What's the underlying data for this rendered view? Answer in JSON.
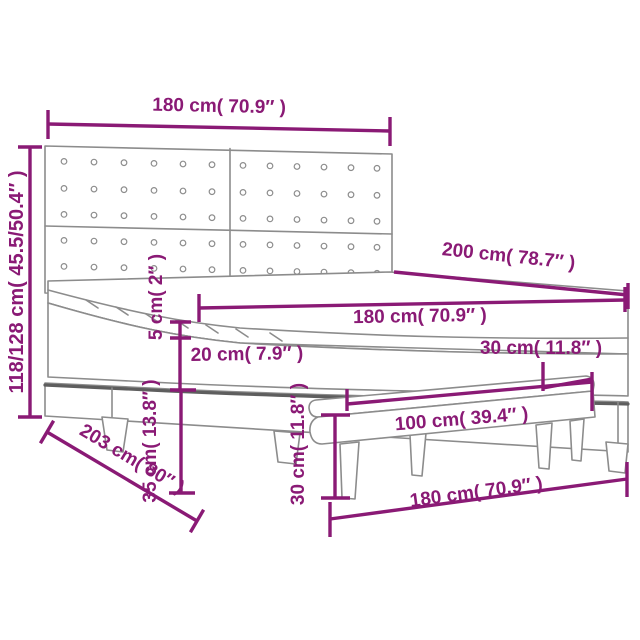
{
  "diagram": {
    "kind": "product-dimension-line-drawing",
    "product": "box-spring-bed-with-tufted-headboard-and-bench",
    "background": "#FFFFFF",
    "colors": {
      "accent": "#8A1A75",
      "line": "#8C8C8C",
      "line_dark": "#5E5E5E"
    },
    "labels": {
      "headboard_width": "180 cm( 70.9″ )",
      "headboard_height": "118/128 cm( 45.5/50.4″ )",
      "bed_length": "200 cm( 78.7″ )",
      "bed_width": "180 cm( 70.9″ )",
      "topper_height": "5 cm( 2″ )",
      "mattress_height": "20 cm( 7.9″ )",
      "base_height": "35 cm( 13.8″ )",
      "bed_depth_floor": "203 cm( 80″ )",
      "bench_height": "30 cm( 11.8″ )",
      "bench_length": "100 cm( 39.4″ )",
      "bench_depth": "30 cm( 11.8″ )",
      "frame_width": "180 cm( 70.9″ )"
    },
    "headboard_buttons": {
      "columns": [
        64,
        94,
        124,
        154,
        183,
        212,
        243,
        270,
        297,
        324,
        351,
        377
      ],
      "rows": [
        161,
        188,
        214,
        240,
        266
      ],
      "tilt_per_px": 0.022,
      "radius": 2.8
    }
  }
}
